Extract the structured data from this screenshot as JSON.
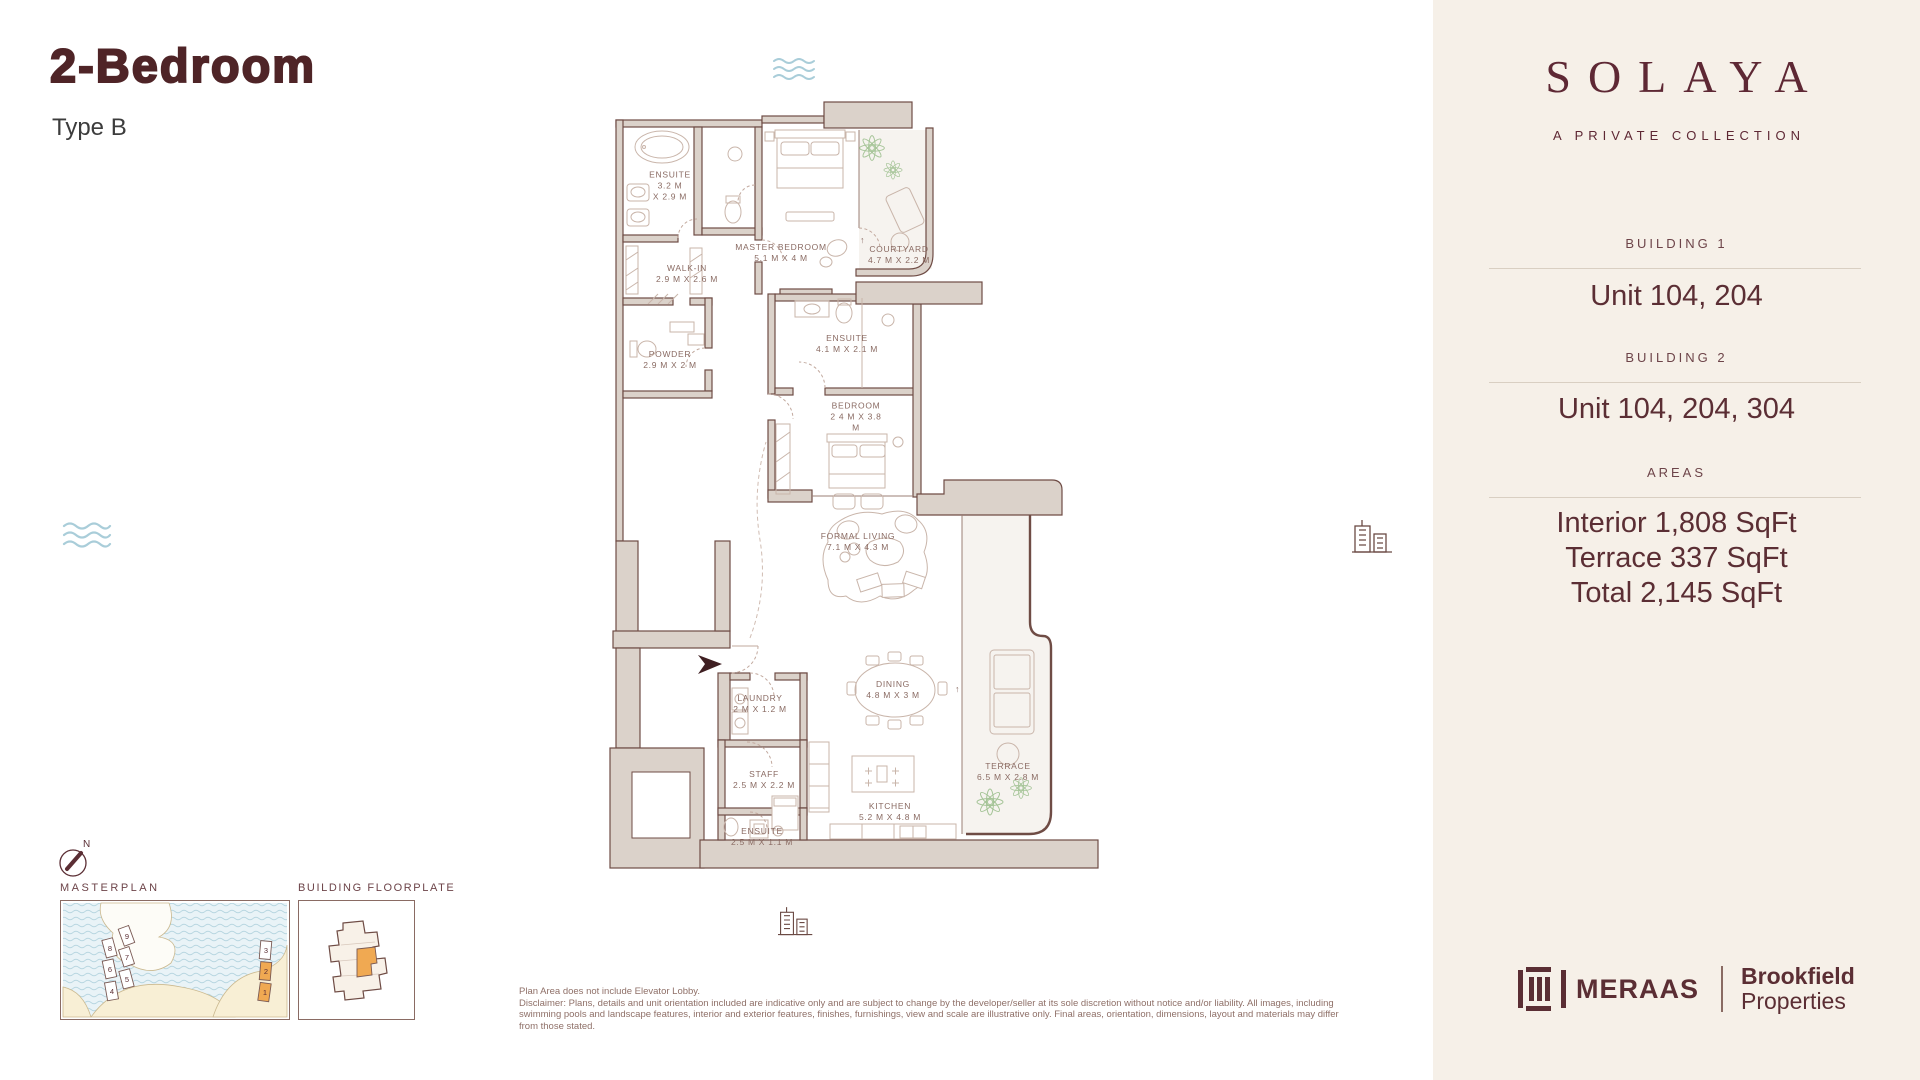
{
  "header": {
    "title": "2-Bedroom",
    "subtitle": "Type B"
  },
  "brand": {
    "name": "SOLAYA",
    "tagline": "A PRIVATE COLLECTION"
  },
  "sidebar": {
    "building1_label": "BUILDING 1",
    "building1_units": "Unit 104, 204",
    "building2_label": "BUILDING 2",
    "building2_units": "Unit 104, 204, 304",
    "areas_label": "AREAS",
    "area_interior": "Interior 1,808 SqFt",
    "area_terrace": "Terrace 337 SqFt",
    "area_total": "Total 2,145 SqFt"
  },
  "partners": {
    "meraas": "MERAAS",
    "brookfield_top": "Brookfield",
    "brookfield_bottom": "Properties"
  },
  "floorplan": {
    "rooms": [
      {
        "name": "ENSUITE",
        "dims": "3.2 M\nX 2.9 M"
      },
      {
        "name": "MASTER BEDROOM",
        "dims": "5.1 M X 4 M"
      },
      {
        "name": "COURTYARD",
        "dims": "4.7 M X 2.2 M"
      },
      {
        "name": "WALK-IN",
        "dims": "2.9 M X 2.6 M"
      },
      {
        "name": "POWDER",
        "dims": "2.9 M X 2 M"
      },
      {
        "name": "ENSUITE",
        "dims": "4.1 M X 2.1 M"
      },
      {
        "name": "BEDROOM",
        "dims": "2 4 M X 3.8\nM"
      },
      {
        "name": "FORMAL LIVING",
        "dims": "7.1 M X 4.3 M"
      },
      {
        "name": "DINING",
        "dims": "4.8 M X 3 M"
      },
      {
        "name": "LAUNDRY",
        "dims": "2 M X 1.2 M"
      },
      {
        "name": "STAFF",
        "dims": "2.5 M X 2.2 M"
      },
      {
        "name": "KITCHEN",
        "dims": "5.2 M X 4.8 M"
      },
      {
        "name": "ENSUITE",
        "dims": "2.5 M X 1.1 M"
      },
      {
        "name": "TERRACE",
        "dims": "6.5 M X 2.8 M"
      }
    ]
  },
  "minimaps": {
    "masterplan_label": "MASTERPLAN",
    "floorplate_label": "BUILDING FLOORPLATE",
    "compass_n": "N",
    "building_numbers": [
      "1",
      "2",
      "3",
      "4",
      "5",
      "6",
      "7",
      "8",
      "9"
    ]
  },
  "disclaimer": {
    "line1": "Plan Area does not include Elevator Lobby.",
    "body": "Disclaimer: Plans, details and unit orientation included are indicative only and are subject to change by the developer/seller at its sole discretion without notice and/or liability. All images, including swimming pools and landscape features, interior and exterior features, finishes, furnishings, view and scale are illustrative only. Final areas, orientation, dimensions, layout and materials may differ from those stated."
  },
  "colors": {
    "brand_maroon": "#5b2e34",
    "title_maroon": "#4f2427",
    "accent_orange": "#f0a952",
    "wall_fill": "#dbd2ca",
    "wall_line": "#6f4c45",
    "water_blue": "#a9cdd9",
    "plant_green": "#a5c497",
    "sidebar_cream": "#f6f0e8"
  },
  "icons": {
    "wave": "wave-lines",
    "buildings": "city-buildings",
    "compass": "north-compass",
    "entry_arrow": "entry-direction-arrow"
  }
}
